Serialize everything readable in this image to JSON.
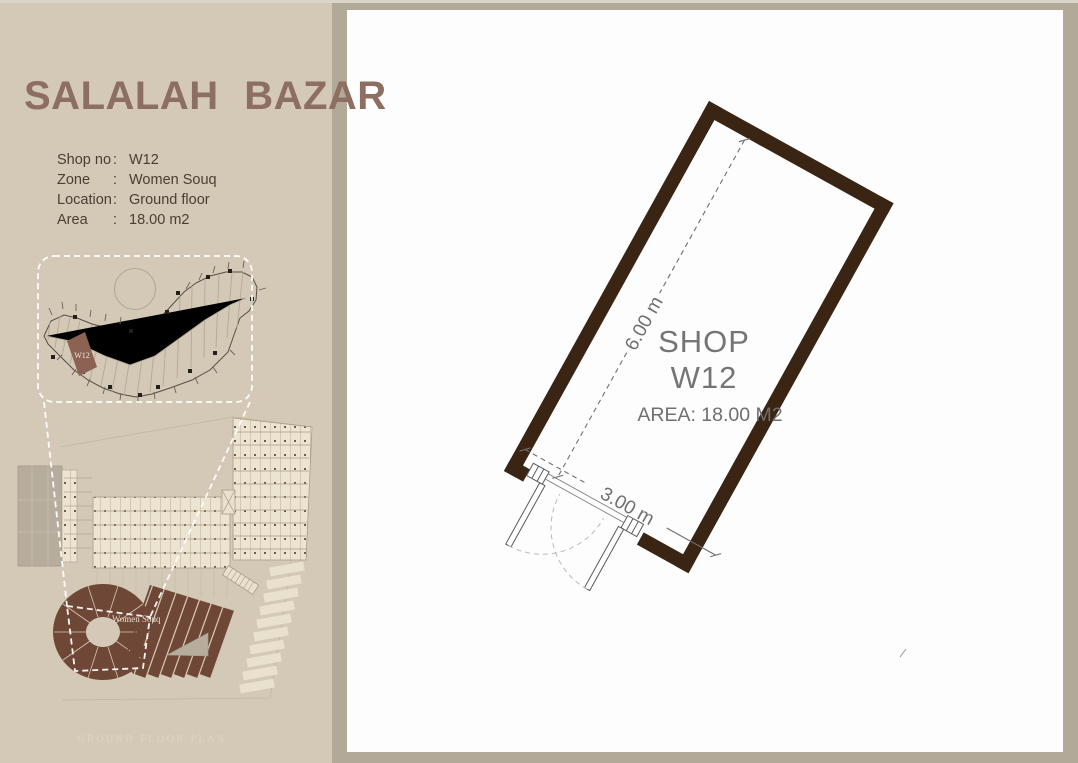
{
  "left_panel": {
    "title": "SALALAH BAZAR",
    "info_separator": ":",
    "info": [
      {
        "label": "Shop no",
        "value": "W12"
      },
      {
        "label": "Zone",
        "value": "Women Souq"
      },
      {
        "label": "Location",
        "value": "Ground floor"
      },
      {
        "label": "Area",
        "value": "18.00 m2"
      }
    ],
    "detail_map": {
      "highlight_label": "W12"
    },
    "site_map": {
      "zone_label": "Women Souq",
      "caption": "GROUND FLOOR PLAN"
    }
  },
  "shop_plan": {
    "shop_line1": "SHOP",
    "shop_line2": "W12",
    "area_label": "AREA: 18.00 M2",
    "dim_long": "6.00 m",
    "dim_short": "3.00 m"
  },
  "colors": {
    "page_bg": "#b2a999",
    "left_panel_bg": "#d4c9b6",
    "title": "#8d6f62",
    "info_text": "#4a3e33",
    "plan_wall": "#3a2413",
    "plan_text_gray": "#757575",
    "souq_brown": "#6f4737",
    "highlight_parcel": "#8c6353",
    "site_cream": "#ece3d0"
  }
}
